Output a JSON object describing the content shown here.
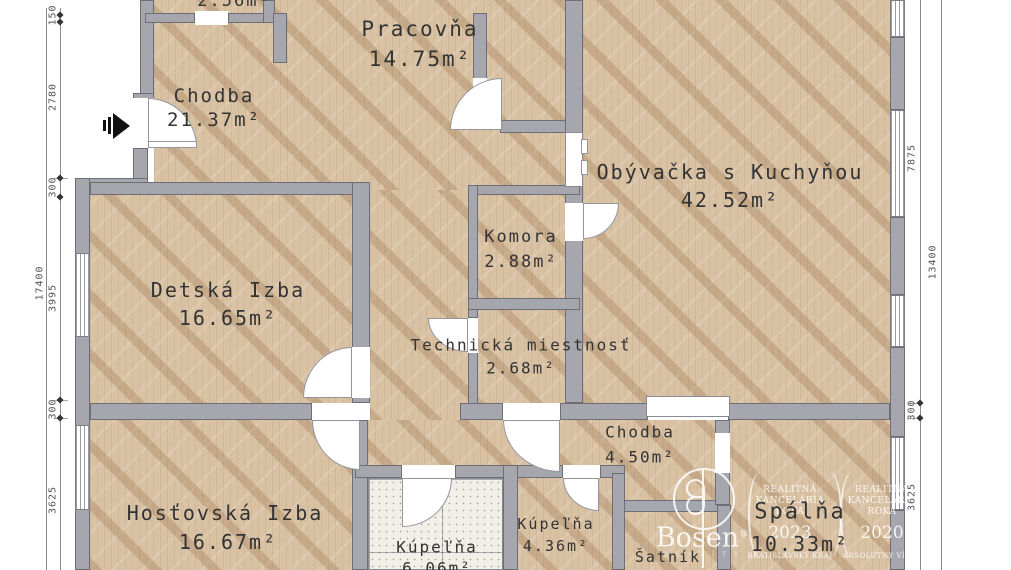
{
  "plan": {
    "rooms": {
      "small_top": {
        "area": "2.56m²"
      },
      "hall_main": {
        "name": "Chodba",
        "area": "21.37m²"
      },
      "office": {
        "name": "Pracovňa",
        "area": "14.75m²"
      },
      "living": {
        "name": "Obývačka s Kuchyňou",
        "area": "42.52m²"
      },
      "pantry": {
        "name": "Komora",
        "area": "2.88m²"
      },
      "utility": {
        "name": "Technická miestnosť",
        "area": "2.68m²"
      },
      "kids": {
        "name": "Detská Izba",
        "area": "16.65m²"
      },
      "guest": {
        "name": "Hosťovská Izba",
        "area": "16.67m²"
      },
      "hall_small": {
        "name": "Chodba",
        "area": "4.50m²"
      },
      "bath_large": {
        "name": "Kúpeľňa",
        "area": "6.06m²"
      },
      "bath_small": {
        "name": "Kúpeľňa",
        "area": "4.36m²"
      },
      "closet": {
        "name": "Šatník"
      },
      "bedroom": {
        "name": "Spálňa",
        "area": "10.33m²"
      }
    },
    "dimensions": {
      "left_total": "17400",
      "left_chain": [
        "150",
        "2780",
        "300",
        "3995",
        "300",
        "3625"
      ],
      "right_total": "13400",
      "right_chain": [
        "7875",
        "300",
        "3625"
      ]
    },
    "watermark": {
      "brand": "Bosen",
      "brand_reg": "®",
      "brand_sub": "R E A L I T Y",
      "badges": [
        {
          "line1": "REALITNÁ",
          "line2": "KANCELÁRIA",
          "line3": "ROKA",
          "year": "2023",
          "subtitle": "BRATISLAVSKÝ KRAJ"
        },
        {
          "line1": "REALITNÁ",
          "line2": "KANCELÁRIA",
          "line3": "ROKA",
          "year": "2020",
          "subtitle": "ABSOLÚTNY VÍŤAZ"
        }
      ]
    },
    "colors": {
      "wall": "#a6a6ae",
      "wood": "#d9c2a4",
      "tile": "#f2efe9",
      "text": "#333333"
    }
  }
}
